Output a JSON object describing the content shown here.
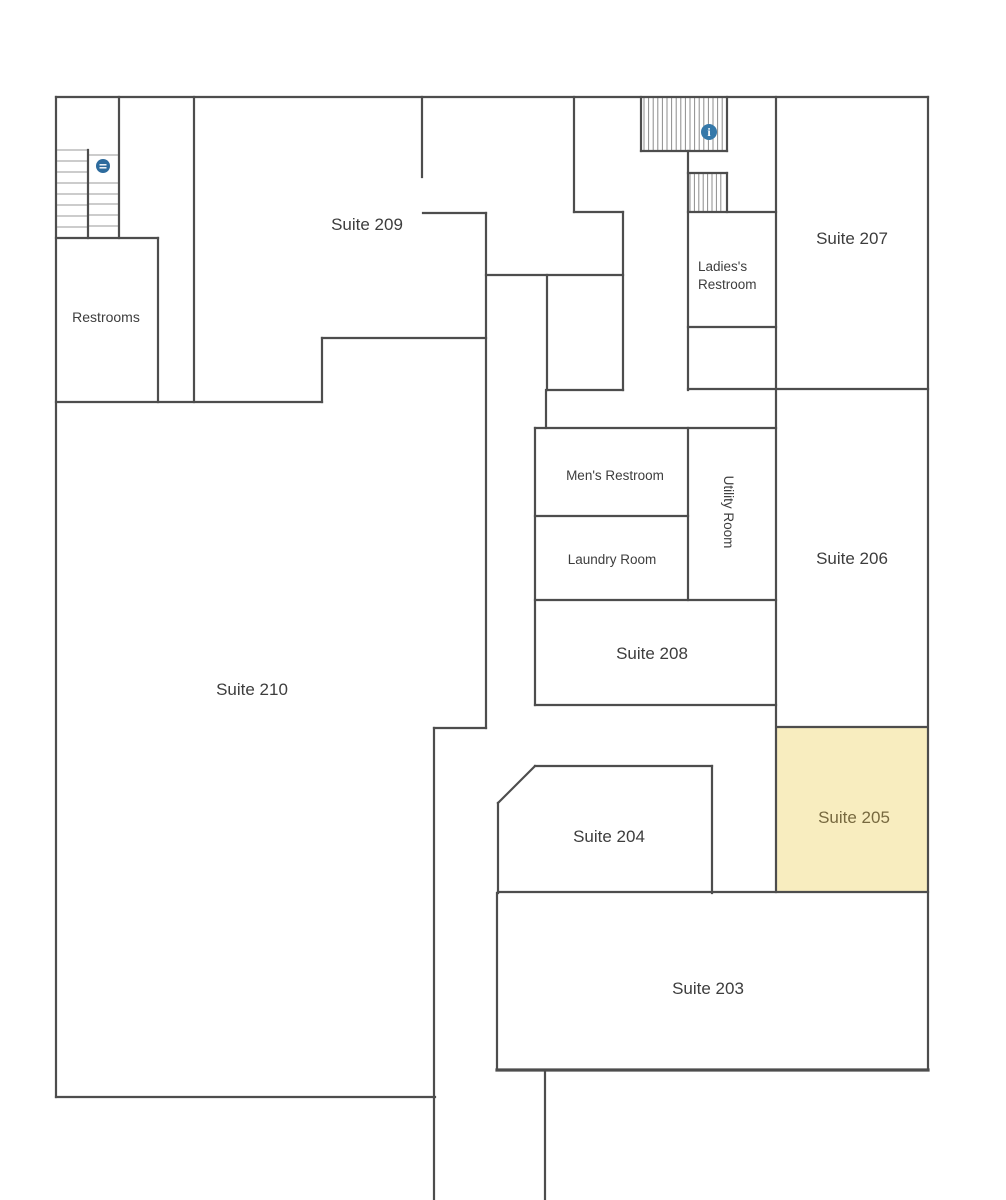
{
  "canvas": {
    "width": 1006,
    "height": 1200,
    "background": "#ffffff"
  },
  "style": {
    "wall_color": "#4d4d4d",
    "wall_width": 2.2,
    "thick_wall_width": 3.2,
    "tread_color": "#9a9a9a",
    "hatch_color": "#8c8c8c",
    "label_color": "#3d3d3d",
    "highlight_fill": "#f8edbf",
    "highlight_label_color": "#77693f",
    "info_icon_color": "#3578a9",
    "stair_icon_color": "#2d6b9d"
  },
  "highlight_room": {
    "name": "suite-205-area",
    "x": 777,
    "y": 727,
    "width": 150,
    "height": 165
  },
  "rooms": [
    {
      "name": "suite-209",
      "label": "Suite 209",
      "cx": 367,
      "cy": 224,
      "size": 17
    },
    {
      "name": "suite-207",
      "label": "Suite 207",
      "cx": 852,
      "cy": 238,
      "size": 17
    },
    {
      "name": "suite-206",
      "label": "Suite 206",
      "cx": 852,
      "cy": 558,
      "size": 17
    },
    {
      "name": "suite-205",
      "label": "Suite 205",
      "cx": 854,
      "cy": 817,
      "size": 17,
      "highlight": true
    },
    {
      "name": "suite-208",
      "label": "Suite 208",
      "cx": 652,
      "cy": 653,
      "size": 17
    },
    {
      "name": "suite-204",
      "label": "Suite 204",
      "cx": 609,
      "cy": 836,
      "size": 17
    },
    {
      "name": "suite-203",
      "label": "Suite 203",
      "cx": 708,
      "cy": 988,
      "size": 17
    },
    {
      "name": "suite-210",
      "label": "Suite 210",
      "cx": 252,
      "cy": 689,
      "size": 17
    },
    {
      "name": "restrooms",
      "label": "Restrooms",
      "cx": 106,
      "cy": 317,
      "size": 14
    },
    {
      "name": "mens-restroom",
      "label": "Men's Restroom",
      "cx": 615,
      "cy": 475,
      "size": 13.5
    },
    {
      "name": "laundry-room",
      "label": "Laundry Room",
      "cx": 612,
      "cy": 559,
      "size": 13.5
    },
    {
      "name": "utility-room",
      "label": "Utility Room",
      "cx": 729,
      "cy": 512,
      "size": 13.5,
      "rotate": 90
    },
    {
      "name": "ladies-restroom",
      "lines": [
        "Ladies's",
        "Restroom"
      ],
      "lx": 698,
      "cy": 266,
      "size": 13.5,
      "line1_y": 271,
      "line2_y": 289
    }
  ],
  "walls": [
    [
      56,
      97,
      928,
      97
    ],
    [
      56,
      97,
      56,
      1097
    ],
    [
      56,
      1097,
      435,
      1097
    ],
    [
      434,
      728,
      434,
      1200
    ],
    [
      928,
      97,
      928,
      1070
    ],
    [
      497,
      893,
      497,
      1070
    ],
    [
      545,
      1070,
      545,
      1200
    ],
    [
      119,
      97,
      119,
      238
    ],
    [
      88,
      150,
      88,
      238
    ],
    [
      56,
      238,
      158,
      238
    ],
    [
      158,
      238,
      158,
      402
    ],
    [
      194,
      97,
      194,
      402
    ],
    [
      56,
      402,
      322,
      402
    ],
    [
      322,
      338,
      322,
      402
    ],
    [
      322,
      338,
      486,
      338
    ],
    [
      486,
      213,
      486,
      728
    ],
    [
      434,
      728,
      486,
      728
    ],
    [
      422,
      97,
      422,
      177
    ],
    [
      423,
      213,
      486,
      213
    ],
    [
      574,
      97,
      574,
      212
    ],
    [
      574,
      212,
      623,
      212
    ],
    [
      623,
      212,
      623,
      390
    ],
    [
      486,
      275,
      623,
      275
    ],
    [
      547,
      275,
      547,
      390
    ],
    [
      547,
      390,
      623,
      390
    ],
    [
      546,
      390,
      546,
      428
    ],
    [
      535,
      428,
      776,
      428
    ],
    [
      535,
      428,
      535,
      705
    ],
    [
      535,
      516,
      688,
      516
    ],
    [
      688,
      428,
      688,
      600
    ],
    [
      535,
      600,
      776,
      600
    ],
    [
      535,
      705,
      776,
      705
    ],
    [
      688,
      151,
      688,
      390
    ],
    [
      688,
      212,
      776,
      212
    ],
    [
      688,
      327,
      776,
      327
    ],
    [
      688,
      389,
      928,
      389
    ],
    [
      776,
      97,
      776,
      892
    ],
    [
      641,
      97,
      641,
      151
    ],
    [
      641,
      151,
      727,
      151
    ],
    [
      727,
      97,
      727,
      151
    ],
    [
      688,
      173,
      727,
      173
    ],
    [
      727,
      173,
      727,
      212
    ],
    [
      777,
      727,
      927,
      727
    ],
    [
      498,
      892,
      928,
      892
    ],
    [
      535,
      766,
      712,
      766
    ],
    [
      535,
      766,
      498,
      803
    ],
    [
      498,
      803,
      498,
      893
    ],
    [
      712,
      766,
      712,
      893
    ]
  ],
  "thick_walls": [
    [
      497,
      1070,
      928,
      1070
    ]
  ],
  "stairs": {
    "left_flight": {
      "x1": 57,
      "x2": 88,
      "treads_y": [
        150,
        161,
        172,
        183,
        194,
        205,
        216,
        227
      ]
    },
    "right_flight": {
      "x1": 88,
      "x2": 119,
      "treads_y": [
        155,
        183,
        194,
        204,
        215,
        226
      ]
    }
  },
  "hatches": [
    {
      "name": "stairwell-hatch-upper",
      "x1": 644,
      "x2": 725,
      "y1": 98,
      "y2": 150,
      "step": 4.6
    },
    {
      "name": "stairwell-hatch-lower",
      "x1": 690,
      "x2": 725,
      "y1": 174,
      "y2": 211,
      "step": 4.4
    }
  ],
  "icons": [
    {
      "name": "info-icon",
      "cx": 709,
      "cy": 132,
      "r": 8,
      "glyph": "i"
    },
    {
      "name": "stairs-marker-icon",
      "cx": 103,
      "cy": 166,
      "r": 7
    }
  ]
}
